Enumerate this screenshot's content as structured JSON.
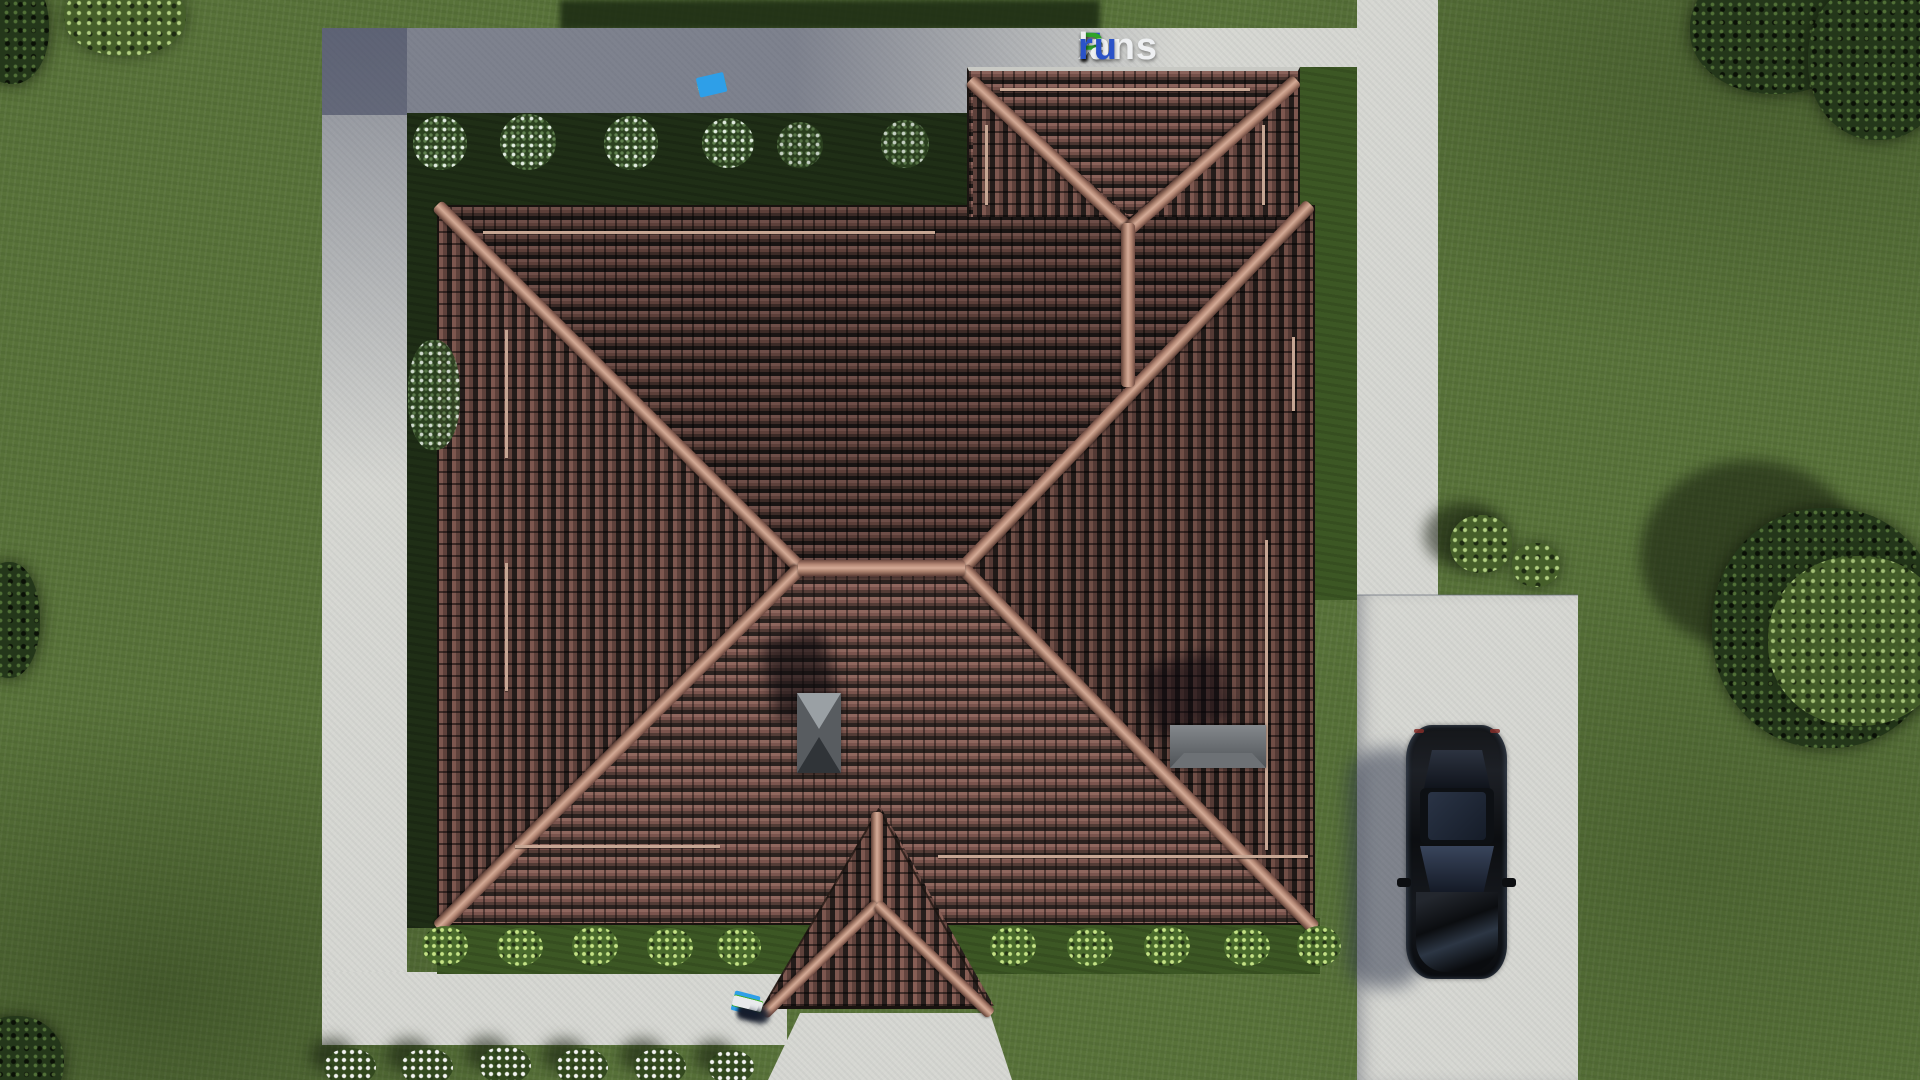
{
  "scene": {
    "type": "3d-aerial-architectural-render",
    "subject": "top-down view of a single-family house with brown hipped tile roof, garage wing, entrance porch, concrete paths, driveway with parked black car, lawn with shrubs and trees"
  },
  "watermark": {
    "site": "FixPlans.ru",
    "parts": [
      {
        "text": "F",
        "color": "#2a52c8"
      },
      {
        "text": "i",
        "color": "#2fa32a"
      },
      {
        "text": "x",
        "color": "#eef0f2"
      },
      {
        "text": "P",
        "color": "#2fa32a"
      },
      {
        "text": "lans",
        "color": "#eef0f2"
      },
      {
        "text": ".",
        "color": "#2a52c8"
      },
      {
        "text": "ru",
        "color": "#2a52c8"
      }
    ]
  },
  "palette": {
    "grass": "#587239",
    "grass_shadow": "#1f2e16",
    "concrete": "#d6d7d2",
    "concrete_shadow": "#6f758c",
    "tile_light": "#8a625a",
    "tile_dark": "#201a18",
    "ridge_beam": "#c9a291",
    "chimney_gray": "#5d6165",
    "car_body": "#0c0e11"
  },
  "rulers": {
    "top": {
      "segments": [
        {
          "c": "#e8eaec",
          "w": 14,
          "h": 8
        },
        {
          "c": "#e8eaec",
          "w": 16,
          "h": 8
        },
        {
          "c": "#1f61d6",
          "w": 12,
          "h": 9
        },
        {
          "c": "#e8eaec",
          "w": 22,
          "h": 9
        },
        {
          "c": "#e8eaec",
          "w": 18,
          "h": 8
        },
        {
          "c": "#e8eaec",
          "w": 16,
          "h": 8
        },
        {
          "c": "#e8eaec",
          "w": 12,
          "h": 8
        },
        {
          "c": "#3fae1f",
          "w": 28,
          "h": 11
        },
        {
          "c": "#e8eaec",
          "w": 16,
          "h": 9
        },
        {
          "c": "#55c032",
          "w": 12,
          "h": 9
        },
        {
          "c": "#2e9fe8",
          "w": 28,
          "h": 20
        }
      ]
    },
    "bottom": {
      "segments": [
        {
          "c": "#2e9fe8",
          "w": 26,
          "h": 20
        },
        {
          "c": "#3fae1f",
          "w": 30,
          "h": 12
        },
        {
          "c": "#e8eaec",
          "w": 18,
          "h": 9
        },
        {
          "c": "#e8eaec",
          "w": 26,
          "h": 10
        },
        {
          "c": "#e8eaec",
          "w": 30,
          "h": 10
        },
        {
          "c": "#1f61d6",
          "w": 14,
          "h": 9
        },
        {
          "c": "#e8eaec",
          "w": 20,
          "h": 9
        },
        {
          "c": "#e8eaec",
          "w": 26,
          "h": 10
        },
        {
          "c": "#e8eaec",
          "w": 18,
          "h": 9
        }
      ]
    }
  }
}
